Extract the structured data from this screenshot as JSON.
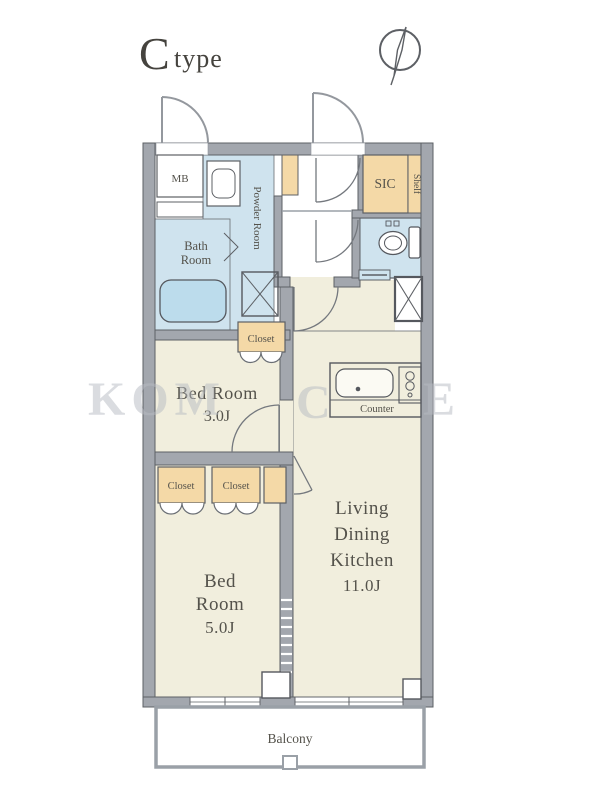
{
  "title": {
    "letter": "C",
    "word": "type"
  },
  "watermark": {
    "part1": "KOM",
    "part2": "C",
    "part3": "E"
  },
  "plan": {
    "rooms": {
      "mb": "MB",
      "powder": "Powder Room",
      "bath_l1": "Bath",
      "bath_l2": "Room",
      "sic": "SIC",
      "shelf": "Shelf",
      "closet_top": "Closet",
      "bed3_l1": "Bed Room",
      "bed3_l2": "3.0J",
      "counter": "Counter",
      "closet_a": "Closet",
      "closet_b": "Closet",
      "bed5_l1": "Bed",
      "bed5_l2": "Room",
      "bed5_l3": "5.0J",
      "ldk_l1": "Living",
      "ldk_l2": "Dining",
      "ldk_l3": "Kitchen",
      "ldk_size": "11.0J",
      "balcony": "Balcony"
    },
    "colors": {
      "wall": "#a3a7ae",
      "wall_edge": "#5d6065",
      "room_cream": "#f1eedd",
      "water_blue": "#cfe3ee",
      "bathtub_blue": "#bcdcec",
      "storage_beige": "#f4d9a7",
      "line": "#5d6065",
      "label_text": "#54524b",
      "watermark": "#b7bbc2"
    }
  }
}
